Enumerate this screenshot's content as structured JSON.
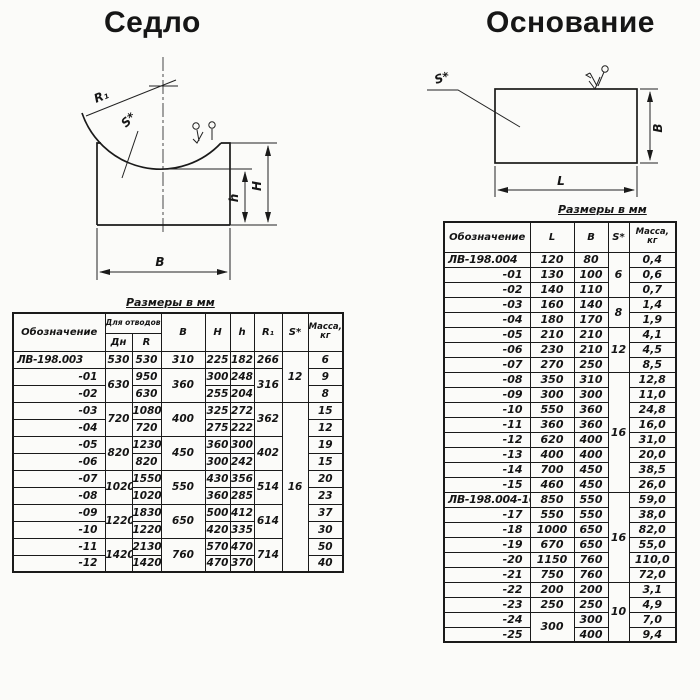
{
  "saddle": {
    "title": "Седло",
    "size_note": "Размеры в мм",
    "drawing_labels": {
      "radius": "R₁",
      "thickness": "S*",
      "height_small": "h",
      "height_big": "H",
      "width": "B"
    },
    "table": {
      "headers": {
        "designation": "Обозначение",
        "group": "Для отводов",
        "dn": "Дн",
        "r": "R",
        "b": "B",
        "h_big": "H",
        "h_small": "h",
        "r1": "R₁",
        "s": "S*",
        "mass": "Масса, кг"
      },
      "rows": [
        [
          "ЛВ-198.003",
          "530",
          "530",
          "310",
          "225",
          "182",
          "266",
          {
            "v": "12",
            "rs": 3
          },
          "6"
        ],
        [
          "-01",
          {
            "v": "630",
            "rs": 2
          },
          "950",
          {
            "v": "360",
            "rs": 2
          },
          "300",
          "248",
          {
            "v": "316",
            "rs": 2
          },
          "9"
        ],
        [
          "-02",
          "630",
          "255",
          "204",
          "8"
        ],
        [
          "-03",
          {
            "v": "720",
            "rs": 2
          },
          "1080",
          {
            "v": "400",
            "rs": 2
          },
          "325",
          "272",
          {
            "v": "362",
            "rs": 2
          },
          {
            "v": "16",
            "rs": 10
          },
          "15"
        ],
        [
          "-04",
          "720",
          "275",
          "222",
          "12"
        ],
        [
          "-05",
          {
            "v": "820",
            "rs": 2
          },
          "1230",
          {
            "v": "450",
            "rs": 2
          },
          "360",
          "300",
          {
            "v": "402",
            "rs": 2
          },
          "19"
        ],
        [
          "-06",
          "820",
          "300",
          "242",
          "15"
        ],
        [
          "-07",
          {
            "v": "1020",
            "rs": 2
          },
          "1550",
          {
            "v": "550",
            "rs": 2
          },
          "430",
          "356",
          {
            "v": "514",
            "rs": 2
          },
          "20"
        ],
        [
          "-08",
          "1020",
          "360",
          "285",
          "23"
        ],
        [
          "-09",
          {
            "v": "1220",
            "rs": 2
          },
          "1830",
          {
            "v": "650",
            "rs": 2
          },
          "500",
          "412",
          {
            "v": "614",
            "rs": 2
          },
          "37"
        ],
        [
          "-10",
          "1220",
          "420",
          "335",
          "30"
        ],
        [
          "-11",
          {
            "v": "1420",
            "rs": 2
          },
          "2130",
          {
            "v": "760",
            "rs": 2
          },
          "570",
          "470",
          {
            "v": "714",
            "rs": 2
          },
          "50"
        ],
        [
          "-12",
          "1420",
          "470",
          "370",
          "40"
        ]
      ]
    }
  },
  "base": {
    "title": "Основание",
    "size_note": "Размеры в мм",
    "drawing_labels": {
      "thickness": "S*",
      "length": "L",
      "width": "B"
    },
    "table": {
      "headers": {
        "designation": "Обозначение",
        "l": "L",
        "b": "B",
        "s": "S*",
        "mass": "Масса, кг"
      },
      "rows": [
        [
          "ЛВ-198.004",
          "120",
          "80",
          {
            "v": "6",
            "rs": 3
          },
          "0,4"
        ],
        [
          "-01",
          "130",
          "100",
          "0,6"
        ],
        [
          "-02",
          "140",
          "110",
          "0,7"
        ],
        [
          "-03",
          "160",
          "140",
          {
            "v": "8",
            "rs": 2
          },
          "1,4"
        ],
        [
          "-04",
          "180",
          "170",
          "1,9"
        ],
        [
          "-05",
          "210",
          "210",
          {
            "v": "12",
            "rs": 3
          },
          "4,1"
        ],
        [
          "-06",
          "230",
          "210",
          "4,5"
        ],
        [
          "-07",
          "270",
          "250",
          "8,5"
        ],
        [
          "-08",
          "350",
          "310",
          {
            "v": "16",
            "rs": 8
          },
          "12,8"
        ],
        [
          "-09",
          "300",
          "300",
          "11,0"
        ],
        [
          "-10",
          "550",
          "360",
          "24,8"
        ],
        [
          "-11",
          "360",
          "360",
          "16,0"
        ],
        [
          "-12",
          "620",
          "400",
          "31,0"
        ],
        [
          "-13",
          "400",
          "400",
          "20,0"
        ],
        [
          "-14",
          "700",
          "450",
          "38,5"
        ],
        [
          "-15",
          "460",
          "450",
          "26,0"
        ],
        [
          "ЛВ-198.004-16",
          "850",
          "550",
          {
            "v": "16",
            "rs": 6
          },
          "59,0"
        ],
        [
          "-17",
          "550",
          "550",
          "38,0"
        ],
        [
          "-18",
          "1000",
          "650",
          "82,0"
        ],
        [
          "-19",
          "670",
          "650",
          "55,0"
        ],
        [
          "-20",
          "1150",
          "760",
          "110,0"
        ],
        [
          "-21",
          "750",
          "760",
          "72,0"
        ],
        [
          "-22",
          "200",
          "200",
          {
            "v": "10",
            "rs": 4
          },
          "3,1"
        ],
        [
          "-23",
          "250",
          "250",
          "4,9"
        ],
        [
          "-24",
          {
            "v": "300",
            "rs": 2
          },
          "300",
          "7,0"
        ],
        [
          "-25",
          "400",
          "9,4"
        ]
      ]
    }
  }
}
